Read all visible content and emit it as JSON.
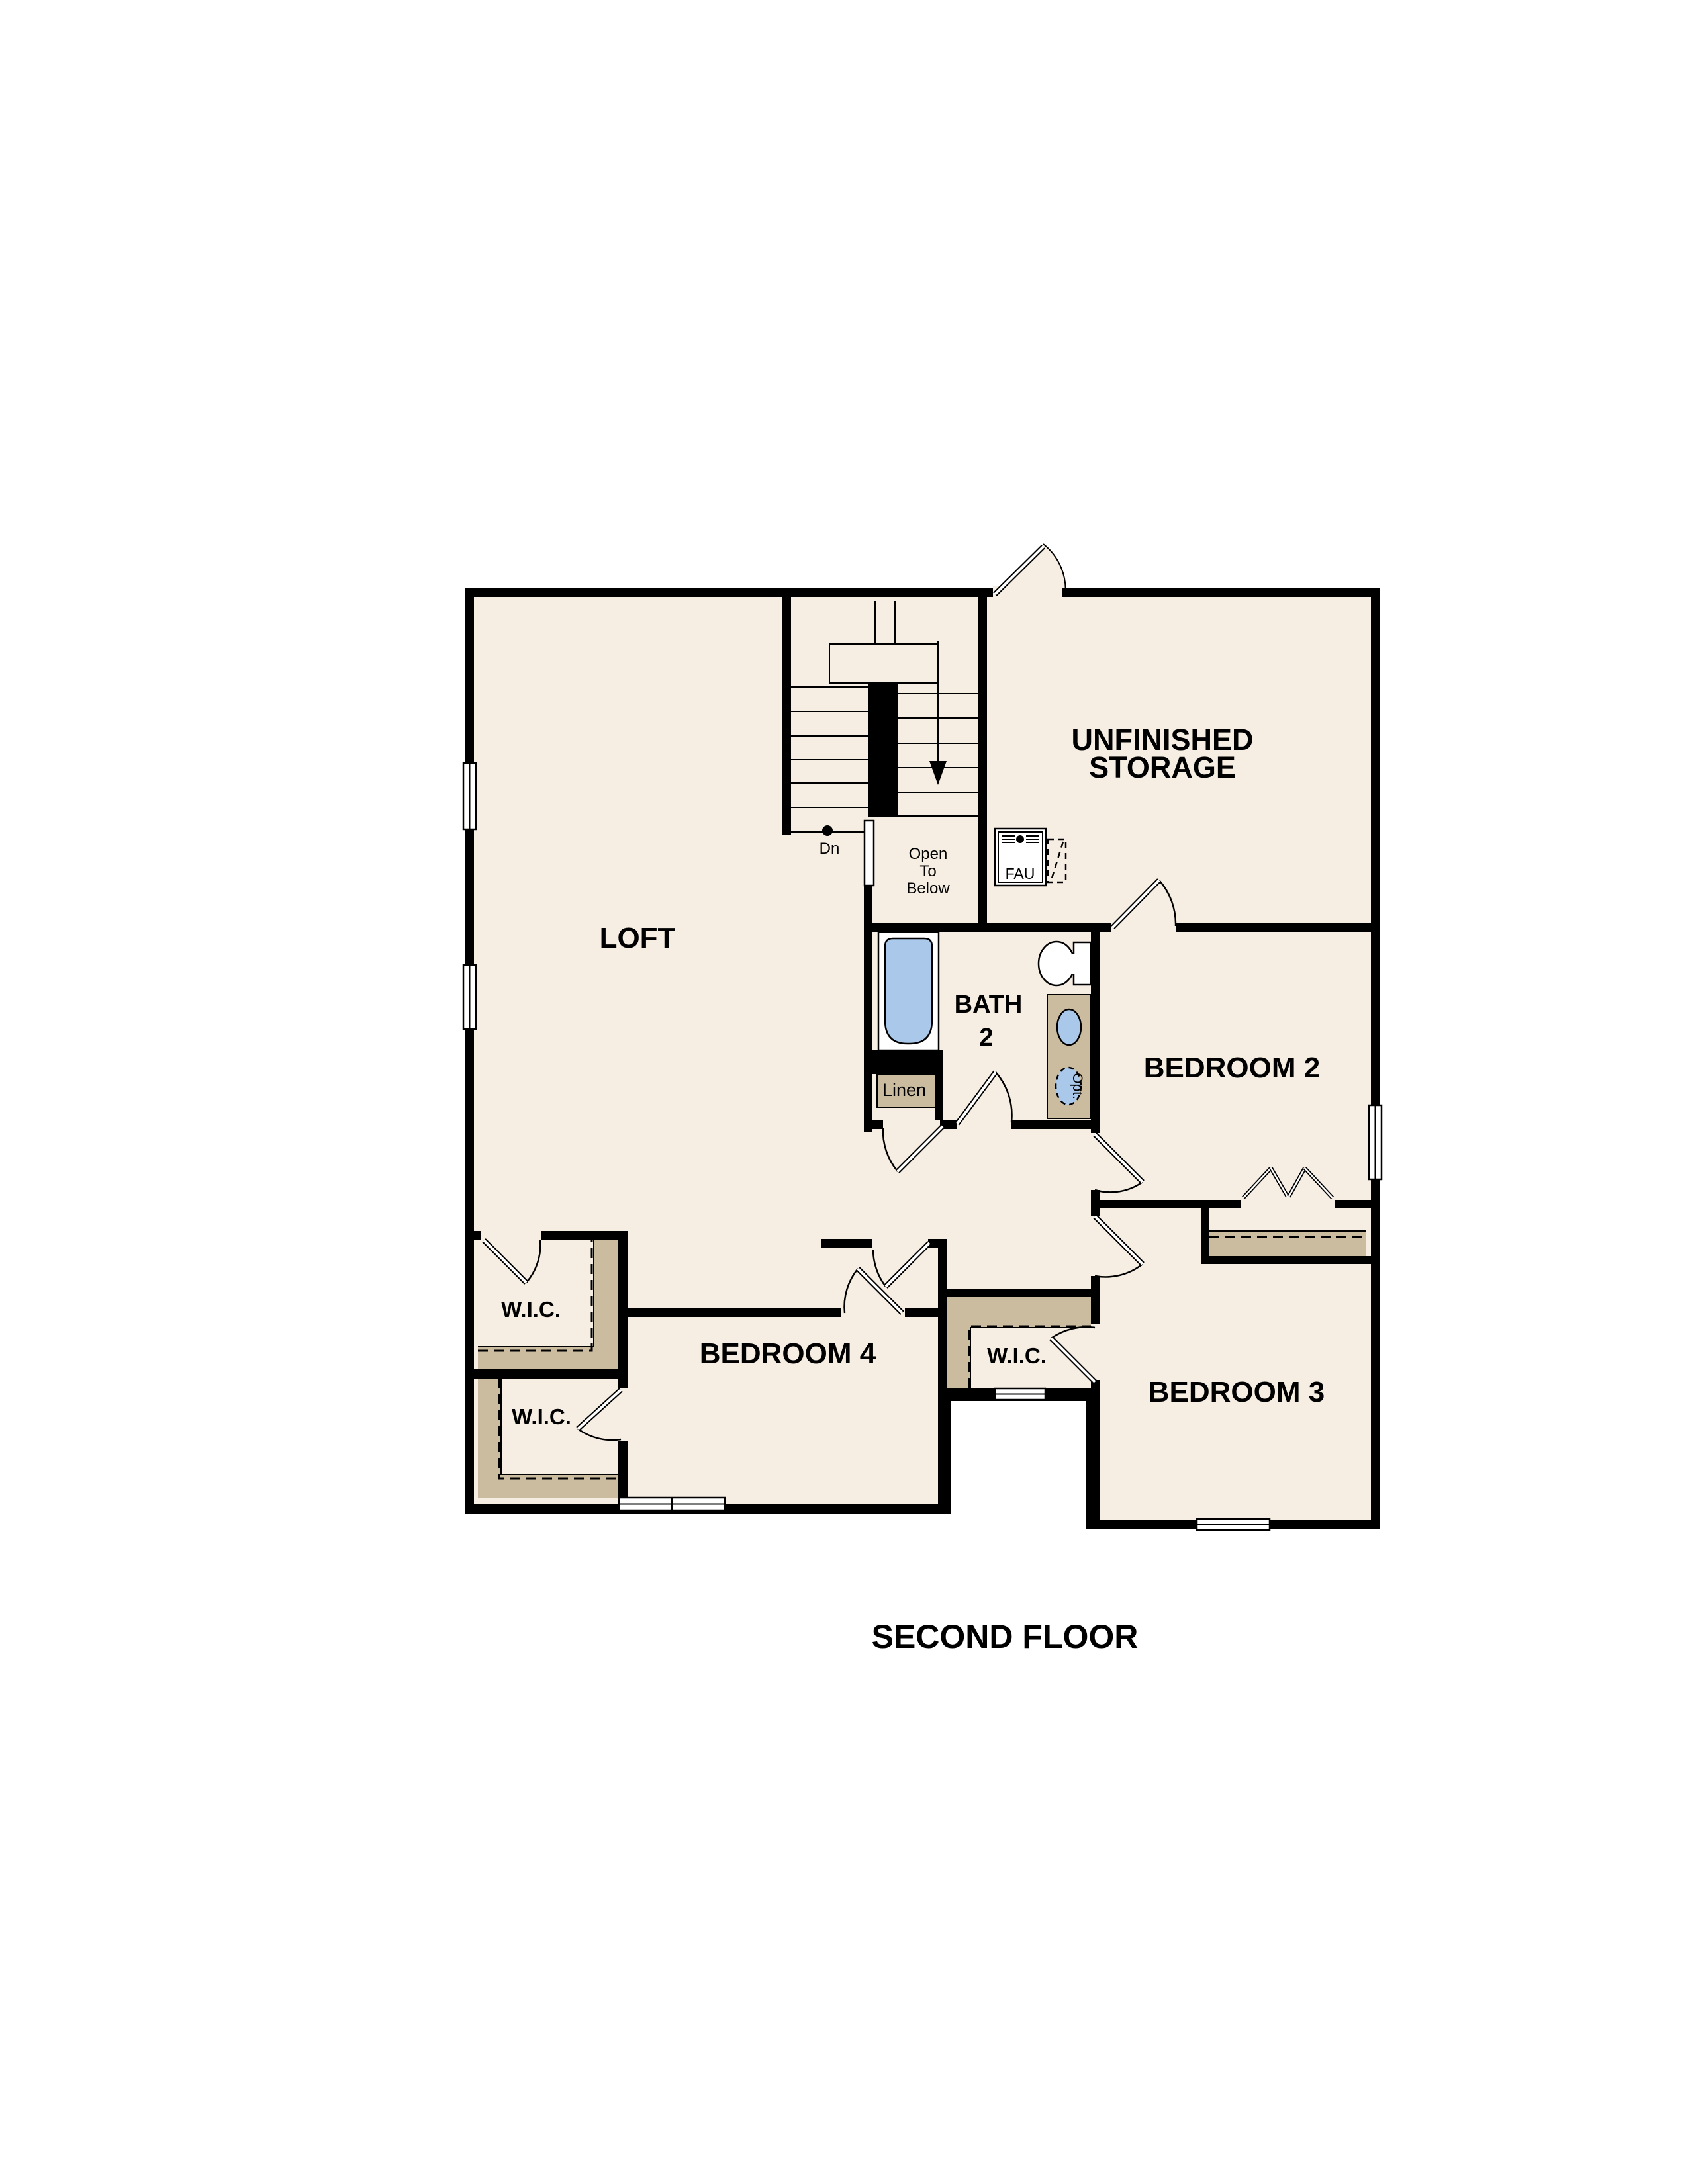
{
  "title": "SECOND FLOOR",
  "colors": {
    "floor": "#f6eee2",
    "cabinet_tan": "#cbbca0",
    "fixture_blue": "#aac9ea",
    "wall": "#000000",
    "background": "#ffffff"
  },
  "rooms": {
    "loft": "LOFT",
    "storage_line1": "UNFINISHED",
    "storage_line2": "STORAGE",
    "bath_line1": "BATH",
    "bath_line2": "2",
    "bedroom2": "BEDROOM 2",
    "bedroom3": "BEDROOM 3",
    "bedroom4": "BEDROOM 4"
  },
  "closets": {
    "wic_loft": "W.I.C.",
    "wic_bedroom4": "W.I.C.",
    "wic_bedroom3": "W.I.C.",
    "linen": "Linen"
  },
  "stairs": {
    "down": "Dn",
    "open_line1": "Open",
    "open_line2": "To",
    "open_line3": "Below"
  },
  "equipment": {
    "fau": "FAU",
    "optional_sink": "Opt."
  }
}
